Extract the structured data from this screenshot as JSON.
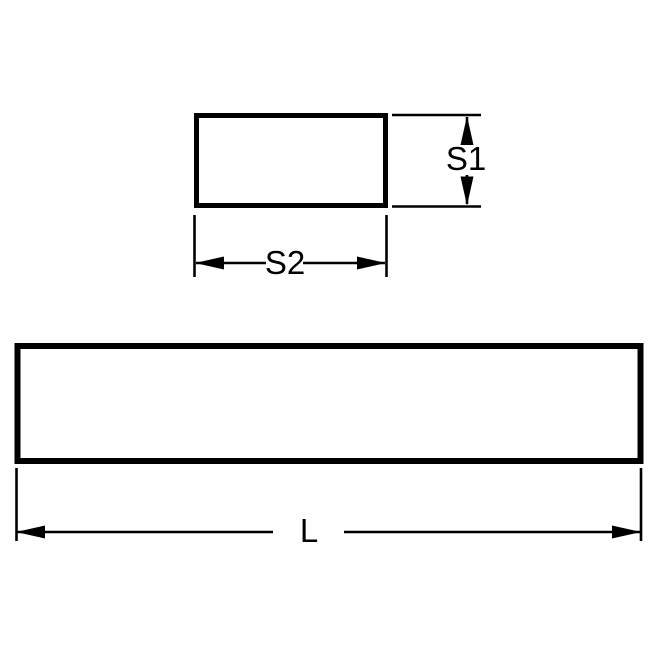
{
  "diagram": {
    "dimension_labels": {
      "s1": "S1",
      "s2": "S2",
      "length": "L"
    },
    "colors": {
      "line": "#000000",
      "text": "#000000",
      "background": "#ffffff"
    }
  }
}
